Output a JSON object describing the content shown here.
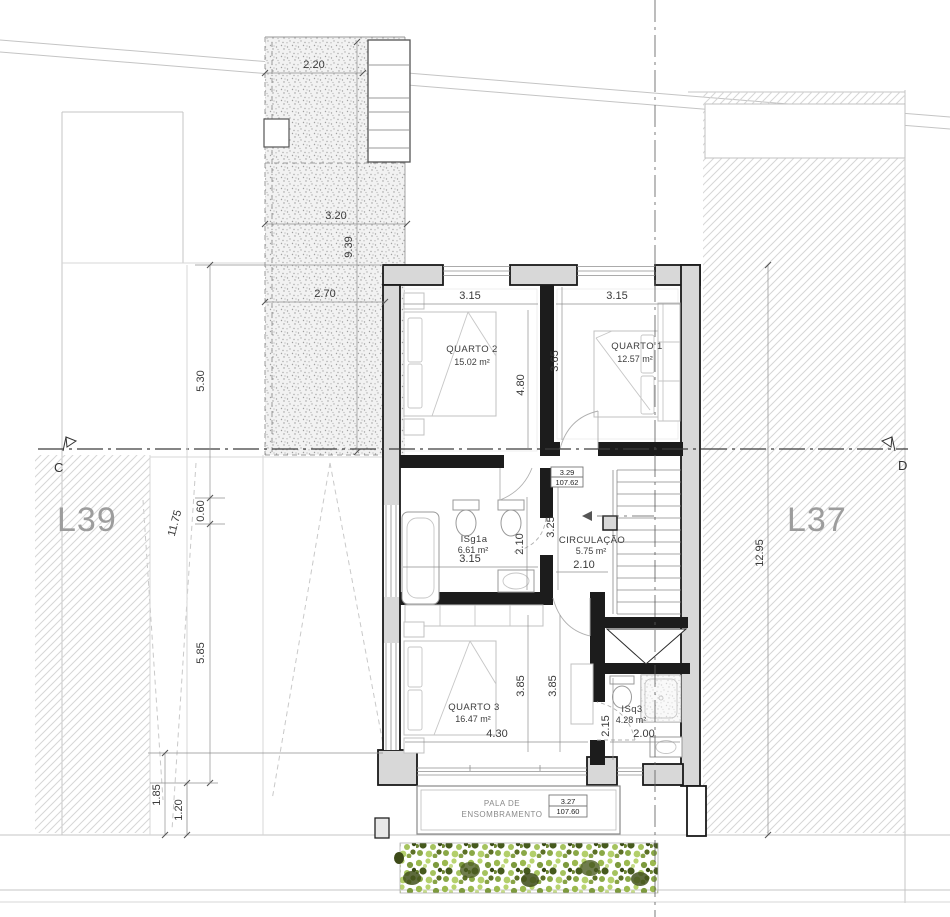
{
  "drawing": {
    "lots": {
      "left_label": "L39",
      "right_label": "L37"
    },
    "section": {
      "left_marker": "C",
      "right_marker": "D"
    },
    "rooms": {
      "quarto2": {
        "name": "QUARTO 2",
        "area": "15.02 m²"
      },
      "quarto1": {
        "name": "QUARTO 1",
        "area": "12.57 m²"
      },
      "isg1a": {
        "name": "ISg1a",
        "area": "6.61 m²"
      },
      "circulacao": {
        "name": "CIRCULAÇÃO",
        "area": "5.75 m²"
      },
      "quarto3": {
        "name": "QUARTO 3",
        "area": "16.47 m²"
      },
      "isq3": {
        "name": "ISq3",
        "area": "4.28 m²"
      }
    },
    "levels": {
      "circulation": {
        "height": "3.29",
        "elevation": "107.62"
      },
      "pala": {
        "height": "3.27",
        "elevation": "107.60"
      }
    },
    "canopy": {
      "line1": "PALA DE",
      "line2": "ENSOMBRAMENTO"
    },
    "dims": {
      "patio_top": "2.20",
      "patio_mid": "3.20",
      "patio_length": "9.39",
      "patio_bottom": "2.70",
      "left_upper": "5.30",
      "left_total": "11.75",
      "left_small": "0.60",
      "left_lower": "5.85",
      "left_bottom_outer": "1.85",
      "left_bottom_inner": "1.20",
      "right_total": "12.95",
      "q2_width": "3.15",
      "q2_depth": "4.80",
      "q1_width": "3.15",
      "q1_depth": "3.65",
      "bath_width": "3.15",
      "bath_depth": "2.10",
      "circ_depth": "3.25",
      "circ_width": "2.10",
      "q3_depth_a": "3.85",
      "q3_depth_b": "3.85",
      "q3_width": "4.30",
      "isq3_depth": "2.15",
      "isq3_width": "2.00"
    },
    "colors": {
      "wall_fill": "#d8d8d8",
      "line": "#1a1a1a",
      "hedge_green": "#9bb94f",
      "lot_label": "#9d9d9d"
    }
  }
}
